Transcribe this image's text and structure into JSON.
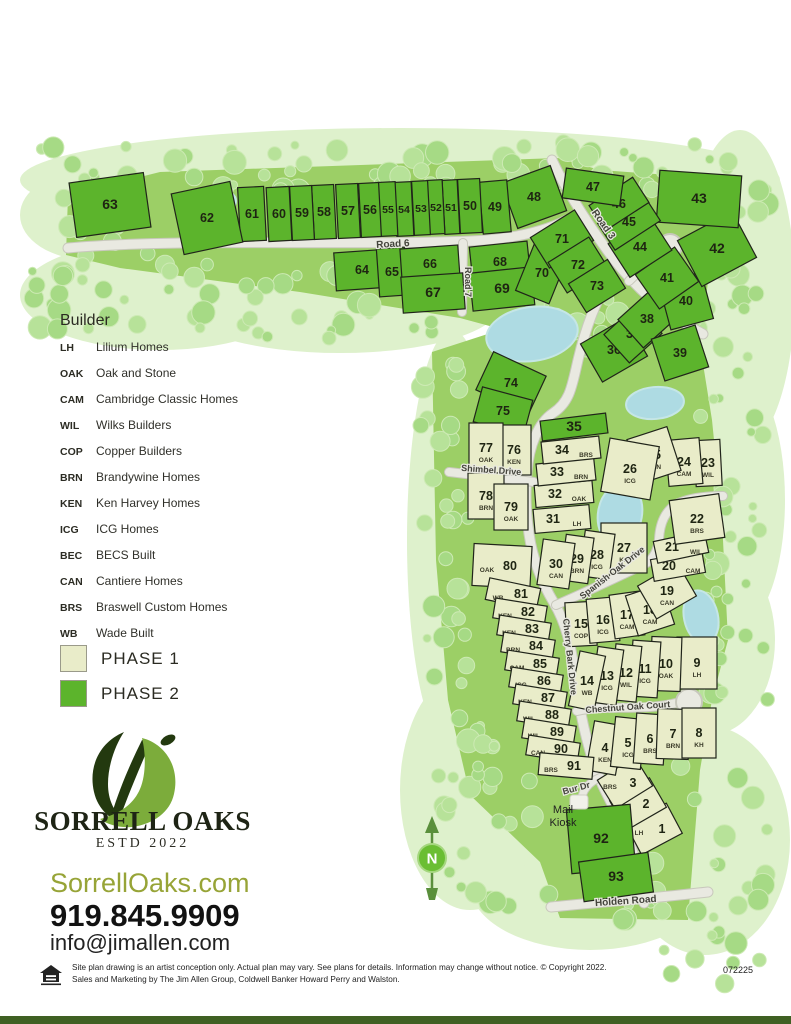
{
  "legend": {
    "title": "Builder",
    "builders": [
      {
        "code": "LH",
        "name": "Lilium Homes"
      },
      {
        "code": "OAK",
        "name": "Oak and Stone"
      },
      {
        "code": "CAM",
        "name": "Cambridge Classic Homes"
      },
      {
        "code": "WIL",
        "name": "Wilks Builders"
      },
      {
        "code": "COP",
        "name": "Copper Builders"
      },
      {
        "code": "BRN",
        "name": "Brandywine Homes"
      },
      {
        "code": "KEN",
        "name": "Ken Harvey Homes"
      },
      {
        "code": "ICG",
        "name": "ICG Homes"
      },
      {
        "code": "BEC",
        "name": "BECS Built"
      },
      {
        "code": "CAN",
        "name": "Cantiere Homes"
      },
      {
        "code": "BRS",
        "name": "Braswell Custom Homes"
      },
      {
        "code": "WB",
        "name": "Wade Built"
      }
    ],
    "phases": [
      {
        "label": "PHASE 1",
        "color": "#e9ecc9"
      },
      {
        "label": "PHASE 2",
        "color": "#5cb42c"
      }
    ]
  },
  "branding": {
    "name": "SORRELL OAKS",
    "estd": "ESTD 2022",
    "website": "SorrellOaks.com",
    "phone": "919.845.9909",
    "email": "info@jimallen.com"
  },
  "footer": {
    "line1": "Site plan drawing is an artist conception only. Actual plan may vary. See plans for details. Information may change without notice. © Copyright 2022.",
    "line2": "Sales and Marketing by The Jim Allen Group, Coldwell Banker Howard Perry and Walston.",
    "code": "072225"
  },
  "colors": {
    "phase1": "#e9ecc9",
    "phase2": "#5cb42c",
    "road": "#e9e9e1",
    "road_casing": "#c8c8bc",
    "water": "#aedbe3",
    "tree_a": "#b7e299",
    "tree_b": "#a6da85",
    "pale": "#def1cc",
    "grass": "#9ccf66",
    "lot_border": "#20241a",
    "label": "#44443c"
  },
  "map": {
    "north_label": "N",
    "mail_kiosk": [
      "Mail",
      "Kiosk"
    ],
    "roads": [
      {
        "name": "Road 6",
        "path": "M68,248 C180,238 340,246 470,241 C515,239 545,231 567,220",
        "w": 9,
        "label": {
          "t": "Road 6",
          "x": 393,
          "y": 247,
          "r": -3,
          "fs": 10
        }
      },
      {
        "name": "Road 3",
        "path": "M552,160 C567,192 586,221 607,250 C627,278 655,308 703,334",
        "w": 9,
        "label": {
          "t": "Road 3",
          "x": 601,
          "y": 226,
          "r": 55,
          "fs": 10
        }
      },
      {
        "name": "Road 7",
        "path": "M463,243 L462,312",
        "w": 8,
        "label": {
          "t": "Road 7",
          "x": 465,
          "y": 282,
          "r": 90,
          "fs": 9
        }
      },
      {
        "name": "Cherry Bark Drive",
        "path": "M610,278 C596,300 585,330 578,360 C572,386 570,402 553,413 C538,423 529,446 527,472 C525,494 526,514 529,534 C533,561 542,583 554,603 C566,623 571,646 574,669 C578,701 583,729 593,761 C603,793 623,819 633,853 C639,875 642,889 644,903",
        "w": 9,
        "label": {
          "t": "Cherry Bark Drive",
          "x": 567,
          "y": 657,
          "r": 84,
          "fs": 9
        }
      },
      {
        "name": "Shimbel Drive",
        "path": "M449,472 L534,482",
        "w": 8,
        "label": {
          "t": "Shimbel Drive",
          "x": 491,
          "y": 473,
          "r": 4,
          "fs": 9
        }
      },
      {
        "name": "Spanish Oak Drive",
        "path": "M556,605 C586,592 616,578 645,564 C654,559 658,549 659,539 C660,521 667,506 684,501 C696,497 710,496 723,496",
        "w": 8,
        "label": {
          "t": "Spanish Oak Drive",
          "x": 614,
          "y": 575,
          "r": -38,
          "fs": 9
        }
      },
      {
        "name": "Chestnut Oak Court",
        "path": "M577,711 C608,704 640,712 676,703",
        "w": 8,
        "label": {
          "t": "Chestnut Oak Court",
          "x": 628,
          "y": 710,
          "r": -4,
          "fs": 9
        }
      },
      {
        "name": "Bur Dr",
        "path": "M601,777 C589,782 581,791 582,801",
        "w": 7,
        "label": {
          "t": "Bur Dr",
          "x": 577,
          "y": 791,
          "r": -15,
          "fs": 9
        }
      },
      {
        "name": "Holden Road",
        "path": "M551,907 C600,902 655,898 708,892",
        "w": 9,
        "label": {
          "t": "Holden Road",
          "x": 626,
          "y": 904,
          "r": -4,
          "fs": 10
        }
      },
      {
        "name": "cul-de-sac spur",
        "path": "M629,281 C643,267 655,257 666,250",
        "w": 8
      }
    ],
    "culdesacs": [
      {
        "x": 670,
        "y": 246,
        "r": 12
      },
      {
        "x": 689,
        "y": 702,
        "r": 13
      }
    ],
    "ponds": [
      {
        "x": 221,
        "y": 201,
        "rx": 15,
        "ry": 11,
        "r": 0
      },
      {
        "x": 532,
        "y": 334,
        "rx": 46,
        "ry": 27,
        "r": -8
      },
      {
        "x": 655,
        "y": 403,
        "rx": 29,
        "ry": 16,
        "r": -5
      },
      {
        "x": 620,
        "y": 514,
        "rx": 22,
        "ry": 31,
        "r": 10
      },
      {
        "x": 701,
        "y": 617,
        "rx": 17,
        "ry": 27,
        "r": -12
      }
    ],
    "lots": [
      {
        "n": 1,
        "p": 1,
        "c": "LH",
        "cp": "l",
        "x": 654,
        "y": 829,
        "w": 46,
        "h": 34,
        "r": -28
      },
      {
        "n": 2,
        "p": 1,
        "c": "CAN",
        "cp": "l",
        "x": 638,
        "y": 804,
        "w": 46,
        "h": 34,
        "r": -30
      },
      {
        "n": 3,
        "p": 1,
        "c": "BRS",
        "cp": "l",
        "x": 625,
        "y": 783,
        "w": 44,
        "h": 34,
        "r": -32
      },
      {
        "n": 4,
        "p": 1,
        "c": "KEN",
        "x": 605,
        "y": 748,
        "w": 30,
        "h": 50,
        "r": 10
      },
      {
        "n": 5,
        "p": 1,
        "c": "ICG",
        "x": 628,
        "y": 743,
        "w": 30,
        "h": 50,
        "r": 6
      },
      {
        "n": 6,
        "p": 1,
        "c": "BRS",
        "x": 650,
        "y": 739,
        "w": 30,
        "h": 50,
        "r": 4
      },
      {
        "n": 7,
        "p": 1,
        "c": "BRN",
        "x": 673,
        "y": 734,
        "w": 32,
        "h": 50,
        "r": 2
      },
      {
        "n": 8,
        "p": 1,
        "c": "KH",
        "x": 699,
        "y": 733,
        "w": 34,
        "h": 50,
        "r": 0
      },
      {
        "n": 9,
        "p": 1,
        "c": "LH",
        "x": 697,
        "y": 663,
        "w": 40,
        "h": 52,
        "r": 0
      },
      {
        "n": 10,
        "p": 1,
        "c": "OAK",
        "x": 666,
        "y": 664,
        "w": 30,
        "h": 54,
        "r": 2
      },
      {
        "n": 11,
        "p": 1,
        "c": "ICG",
        "x": 645,
        "y": 669,
        "w": 28,
        "h": 56,
        "r": 4
      },
      {
        "n": 12,
        "p": 1,
        "c": "WIL",
        "x": 626,
        "y": 673,
        "w": 26,
        "h": 56,
        "r": 6
      },
      {
        "n": 13,
        "p": 1,
        "c": "ICG",
        "x": 607,
        "y": 676,
        "w": 26,
        "h": 56,
        "r": 8
      },
      {
        "n": 14,
        "p": 1,
        "c": "WB",
        "x": 587,
        "y": 681,
        "w": 26,
        "h": 56,
        "r": 12
      },
      {
        "n": 15,
        "p": 1,
        "c": "COP",
        "x": 581,
        "y": 624,
        "w": 30,
        "h": 44,
        "r": -3
      },
      {
        "n": 16,
        "p": 1,
        "c": "ICG",
        "x": 603,
        "y": 620,
        "w": 30,
        "h": 44,
        "r": -5
      },
      {
        "n": 17,
        "p": 1,
        "c": "CAM",
        "x": 627,
        "y": 615,
        "w": 30,
        "h": 44,
        "r": -8
      },
      {
        "n": 18,
        "p": 1,
        "c": "CAM",
        "x": 650,
        "y": 610,
        "w": 38,
        "h": 42,
        "r": -18
      },
      {
        "n": 19,
        "p": 1,
        "c": "CAN",
        "x": 667,
        "y": 591,
        "w": 46,
        "h": 38,
        "r": -30
      },
      {
        "n": 20,
        "p": 1,
        "c": "CAM",
        "cp": "r",
        "x": 678,
        "y": 566,
        "w": 52,
        "h": 22,
        "r": -10
      },
      {
        "n": 21,
        "p": 1,
        "c": "WIL",
        "cp": "r",
        "x": 681,
        "y": 547,
        "w": 52,
        "h": 22,
        "r": -12
      },
      {
        "n": 22,
        "p": 1,
        "c": "BRS",
        "x": 697,
        "y": 519,
        "w": 50,
        "h": 44,
        "r": -8
      },
      {
        "n": 23,
        "p": 1,
        "c": "WIL",
        "x": 708,
        "y": 463,
        "w": 26,
        "h": 46,
        "r": -3
      },
      {
        "n": 24,
        "p": 1,
        "c": "CAM",
        "x": 684,
        "y": 462,
        "w": 34,
        "h": 46,
        "r": -5
      },
      {
        "n": 25,
        "p": 1,
        "c": "CAN",
        "x": 654,
        "y": 455,
        "w": 42,
        "h": 46,
        "r": -18
      },
      {
        "n": 26,
        "p": 1,
        "c": "ICG",
        "x": 630,
        "y": 469,
        "w": 50,
        "h": 54,
        "r": 10
      },
      {
        "n": 27,
        "p": 1,
        "c": "KH",
        "x": 624,
        "y": 548,
        "w": 46,
        "h": 50,
        "r": 0
      },
      {
        "n": 28,
        "p": 1,
        "c": "ICG",
        "x": 597,
        "y": 555,
        "w": 30,
        "h": 46,
        "r": 8
      },
      {
        "n": 29,
        "p": 1,
        "c": "BRN",
        "x": 577,
        "y": 559,
        "w": 28,
        "h": 46,
        "r": 8
      },
      {
        "n": 30,
        "p": 1,
        "c": "CAN",
        "x": 556,
        "y": 564,
        "w": 32,
        "h": 46,
        "r": 8
      },
      {
        "n": 31,
        "p": 1,
        "c": "LH",
        "cp": "r",
        "x": 562,
        "y": 519,
        "w": 56,
        "h": 24,
        "r": -5
      },
      {
        "n": 32,
        "p": 1,
        "c": "OAK",
        "cp": "r",
        "x": 564,
        "y": 494,
        "w": 58,
        "h": 22,
        "r": -5
      },
      {
        "n": 33,
        "p": 1,
        "c": "BRN",
        "cp": "r",
        "x": 566,
        "y": 472,
        "w": 58,
        "h": 22,
        "r": -6
      },
      {
        "n": 34,
        "p": 1,
        "c": "BRS",
        "cp": "r",
        "x": 571,
        "y": 450,
        "w": 58,
        "h": 22,
        "r": -6
      },
      {
        "n": 35,
        "p": 2,
        "x": 574,
        "y": 427,
        "w": 66,
        "h": 20,
        "r": -7
      },
      {
        "n": 36,
        "p": 2,
        "x": 614,
        "y": 350,
        "w": 52,
        "h": 44,
        "r": -30
      },
      {
        "n": 37,
        "p": 2,
        "x": 633,
        "y": 334,
        "w": 44,
        "h": 38,
        "r": -42
      },
      {
        "n": 38,
        "p": 2,
        "x": 647,
        "y": 319,
        "w": 44,
        "h": 38,
        "r": -42
      },
      {
        "n": 39,
        "p": 2,
        "x": 680,
        "y": 353,
        "w": 46,
        "h": 44,
        "r": -18
      },
      {
        "n": 40,
        "p": 2,
        "x": 686,
        "y": 301,
        "w": 44,
        "h": 48,
        "r": -15
      },
      {
        "n": 41,
        "p": 2,
        "x": 667,
        "y": 278,
        "w": 48,
        "h": 42,
        "r": -35
      },
      {
        "n": 42,
        "p": 2,
        "x": 717,
        "y": 249,
        "w": 62,
        "h": 52,
        "r": -28
      },
      {
        "n": 43,
        "p": 2,
        "x": 699,
        "y": 199,
        "w": 82,
        "h": 52,
        "r": 4
      },
      {
        "n": 44,
        "p": 2,
        "x": 640,
        "y": 247,
        "w": 50,
        "h": 40,
        "r": -33
      },
      {
        "n": 45,
        "p": 2,
        "x": 629,
        "y": 222,
        "w": 54,
        "h": 32,
        "r": -33
      },
      {
        "n": 46,
        "p": 2,
        "x": 619,
        "y": 204,
        "w": 52,
        "h": 30,
        "r": -33
      },
      {
        "n": 47,
        "p": 2,
        "x": 593,
        "y": 187,
        "w": 58,
        "h": 30,
        "r": 8
      },
      {
        "n": 48,
        "p": 2,
        "x": 534,
        "y": 197,
        "w": 52,
        "h": 48,
        "r": -20
      },
      {
        "n": 49,
        "p": 2,
        "x": 495,
        "y": 207,
        "w": 28,
        "h": 52,
        "r": -5
      },
      {
        "n": 50,
        "p": 2,
        "x": 470,
        "y": 206,
        "w": 22,
        "h": 54,
        "r": -3
      },
      {
        "n": 51,
        "p": 2,
        "x": 451,
        "y": 207,
        "w": 15,
        "h": 54,
        "r": -3
      },
      {
        "n": 52,
        "p": 2,
        "x": 436,
        "y": 207,
        "w": 15,
        "h": 54,
        "r": -3
      },
      {
        "n": 53,
        "p": 2,
        "x": 421,
        "y": 208,
        "w": 16,
        "h": 54,
        "r": -3
      },
      {
        "n": 54,
        "p": 2,
        "x": 404,
        "y": 209,
        "w": 17,
        "h": 54,
        "r": -3
      },
      {
        "n": 55,
        "p": 2,
        "x": 388,
        "y": 209,
        "w": 17,
        "h": 54,
        "r": -3
      },
      {
        "n": 56,
        "p": 2,
        "x": 370,
        "y": 210,
        "w": 20,
        "h": 54,
        "r": -3
      },
      {
        "n": 57,
        "p": 2,
        "x": 348,
        "y": 211,
        "w": 22,
        "h": 54,
        "r": -3
      },
      {
        "n": 58,
        "p": 2,
        "x": 324,
        "y": 212,
        "w": 22,
        "h": 54,
        "r": -3
      },
      {
        "n": 59,
        "p": 2,
        "x": 302,
        "y": 213,
        "w": 22,
        "h": 54,
        "r": -3
      },
      {
        "n": 60,
        "p": 2,
        "x": 279,
        "y": 214,
        "w": 23,
        "h": 54,
        "r": -3
      },
      {
        "n": 61,
        "p": 2,
        "x": 252,
        "y": 214,
        "w": 26,
        "h": 54,
        "r": -3
      },
      {
        "n": 62,
        "p": 2,
        "x": 207,
        "y": 218,
        "w": 60,
        "h": 62,
        "r": -12
      },
      {
        "n": 63,
        "p": 2,
        "x": 110,
        "y": 205,
        "w": 75,
        "h": 55,
        "r": -8
      },
      {
        "n": 64,
        "p": 2,
        "x": 362,
        "y": 270,
        "w": 54,
        "h": 38,
        "r": -4
      },
      {
        "n": 65,
        "p": 2,
        "x": 392,
        "y": 272,
        "w": 28,
        "h": 48,
        "r": -4
      },
      {
        "n": 66,
        "p": 2,
        "x": 430,
        "y": 264,
        "w": 58,
        "h": 34,
        "r": -4
      },
      {
        "n": 67,
        "p": 2,
        "x": 433,
        "y": 293,
        "w": 62,
        "h": 36,
        "r": -4
      },
      {
        "n": 68,
        "p": 2,
        "x": 500,
        "y": 262,
        "w": 58,
        "h": 36,
        "r": -6
      },
      {
        "n": 69,
        "p": 2,
        "x": 502,
        "y": 289,
        "w": 62,
        "h": 38,
        "r": -6
      },
      {
        "n": 70,
        "p": 2,
        "x": 542,
        "y": 273,
        "w": 36,
        "h": 52,
        "r": 22
      },
      {
        "n": 71,
        "p": 2,
        "x": 562,
        "y": 239,
        "w": 52,
        "h": 36,
        "r": -32
      },
      {
        "n": 72,
        "p": 2,
        "x": 578,
        "y": 265,
        "w": 48,
        "h": 36,
        "r": -32
      },
      {
        "n": 73,
        "p": 2,
        "x": 597,
        "y": 286,
        "w": 46,
        "h": 34,
        "r": -32
      },
      {
        "n": 74,
        "p": 2,
        "x": 511,
        "y": 383,
        "w": 58,
        "h": 42,
        "r": 25
      },
      {
        "n": 75,
        "p": 2,
        "x": 503,
        "y": 411,
        "w": 52,
        "h": 36,
        "r": 15
      },
      {
        "n": 76,
        "p": 1,
        "c": "KEN",
        "x": 514,
        "y": 450,
        "w": 34,
        "h": 50,
        "r": 0
      },
      {
        "n": 77,
        "p": 1,
        "c": "OAK",
        "x": 486,
        "y": 448,
        "w": 34,
        "h": 50,
        "r": 0
      },
      {
        "n": 78,
        "p": 1,
        "c": "BRN",
        "x": 486,
        "y": 496,
        "w": 36,
        "h": 46,
        "r": 0
      },
      {
        "n": 79,
        "p": 1,
        "c": "OAK",
        "x": 511,
        "y": 507,
        "w": 34,
        "h": 46,
        "r": 0
      },
      {
        "n": 80,
        "p": 1,
        "c": "OAK",
        "cp": "l",
        "x": 502,
        "y": 566,
        "w": 58,
        "h": 42,
        "r": 3
      },
      {
        "n": 81,
        "p": 1,
        "c": "WB",
        "cp": "l",
        "x": 513,
        "y": 594,
        "w": 52,
        "h": 22,
        "r": 12
      },
      {
        "n": 82,
        "p": 1,
        "c": "KEN",
        "cp": "l",
        "x": 520,
        "y": 612,
        "w": 52,
        "h": 20,
        "r": 9
      },
      {
        "n": 83,
        "p": 1,
        "c": "KEN",
        "cp": "l",
        "x": 524,
        "y": 629,
        "w": 52,
        "h": 20,
        "r": 9
      },
      {
        "n": 84,
        "p": 1,
        "c": "BRN",
        "cp": "l",
        "x": 528,
        "y": 646,
        "w": 52,
        "h": 20,
        "r": 9
      },
      {
        "n": 85,
        "p": 1,
        "c": "CAM",
        "cp": "l",
        "x": 532,
        "y": 664,
        "w": 52,
        "h": 20,
        "r": 9
      },
      {
        "n": 86,
        "p": 1,
        "c": "ICG",
        "cp": "l",
        "x": 536,
        "y": 681,
        "w": 52,
        "h": 20,
        "r": 9
      },
      {
        "n": 87,
        "p": 1,
        "c": "KEN",
        "cp": "l",
        "x": 540,
        "y": 698,
        "w": 52,
        "h": 20,
        "r": 9
      },
      {
        "n": 88,
        "p": 1,
        "c": "WIL",
        "cp": "l",
        "x": 544,
        "y": 715,
        "w": 52,
        "h": 20,
        "r": 9
      },
      {
        "n": 89,
        "p": 1,
        "c": "WIL",
        "cp": "l",
        "x": 549,
        "y": 732,
        "w": 52,
        "h": 20,
        "r": 9
      },
      {
        "n": 90,
        "p": 1,
        "c": "CAN",
        "cp": "l",
        "x": 553,
        "y": 749,
        "w": 52,
        "h": 20,
        "r": 9
      },
      {
        "n": 91,
        "p": 1,
        "c": "BRS",
        "cp": "l",
        "x": 566,
        "y": 766,
        "w": 54,
        "h": 22,
        "r": 5
      },
      {
        "n": 92,
        "p": 2,
        "x": 601,
        "y": 839,
        "w": 64,
        "h": 64,
        "r": -5
      },
      {
        "n": 93,
        "p": 2,
        "x": 616,
        "y": 877,
        "w": 70,
        "h": 40,
        "r": -8
      }
    ]
  }
}
